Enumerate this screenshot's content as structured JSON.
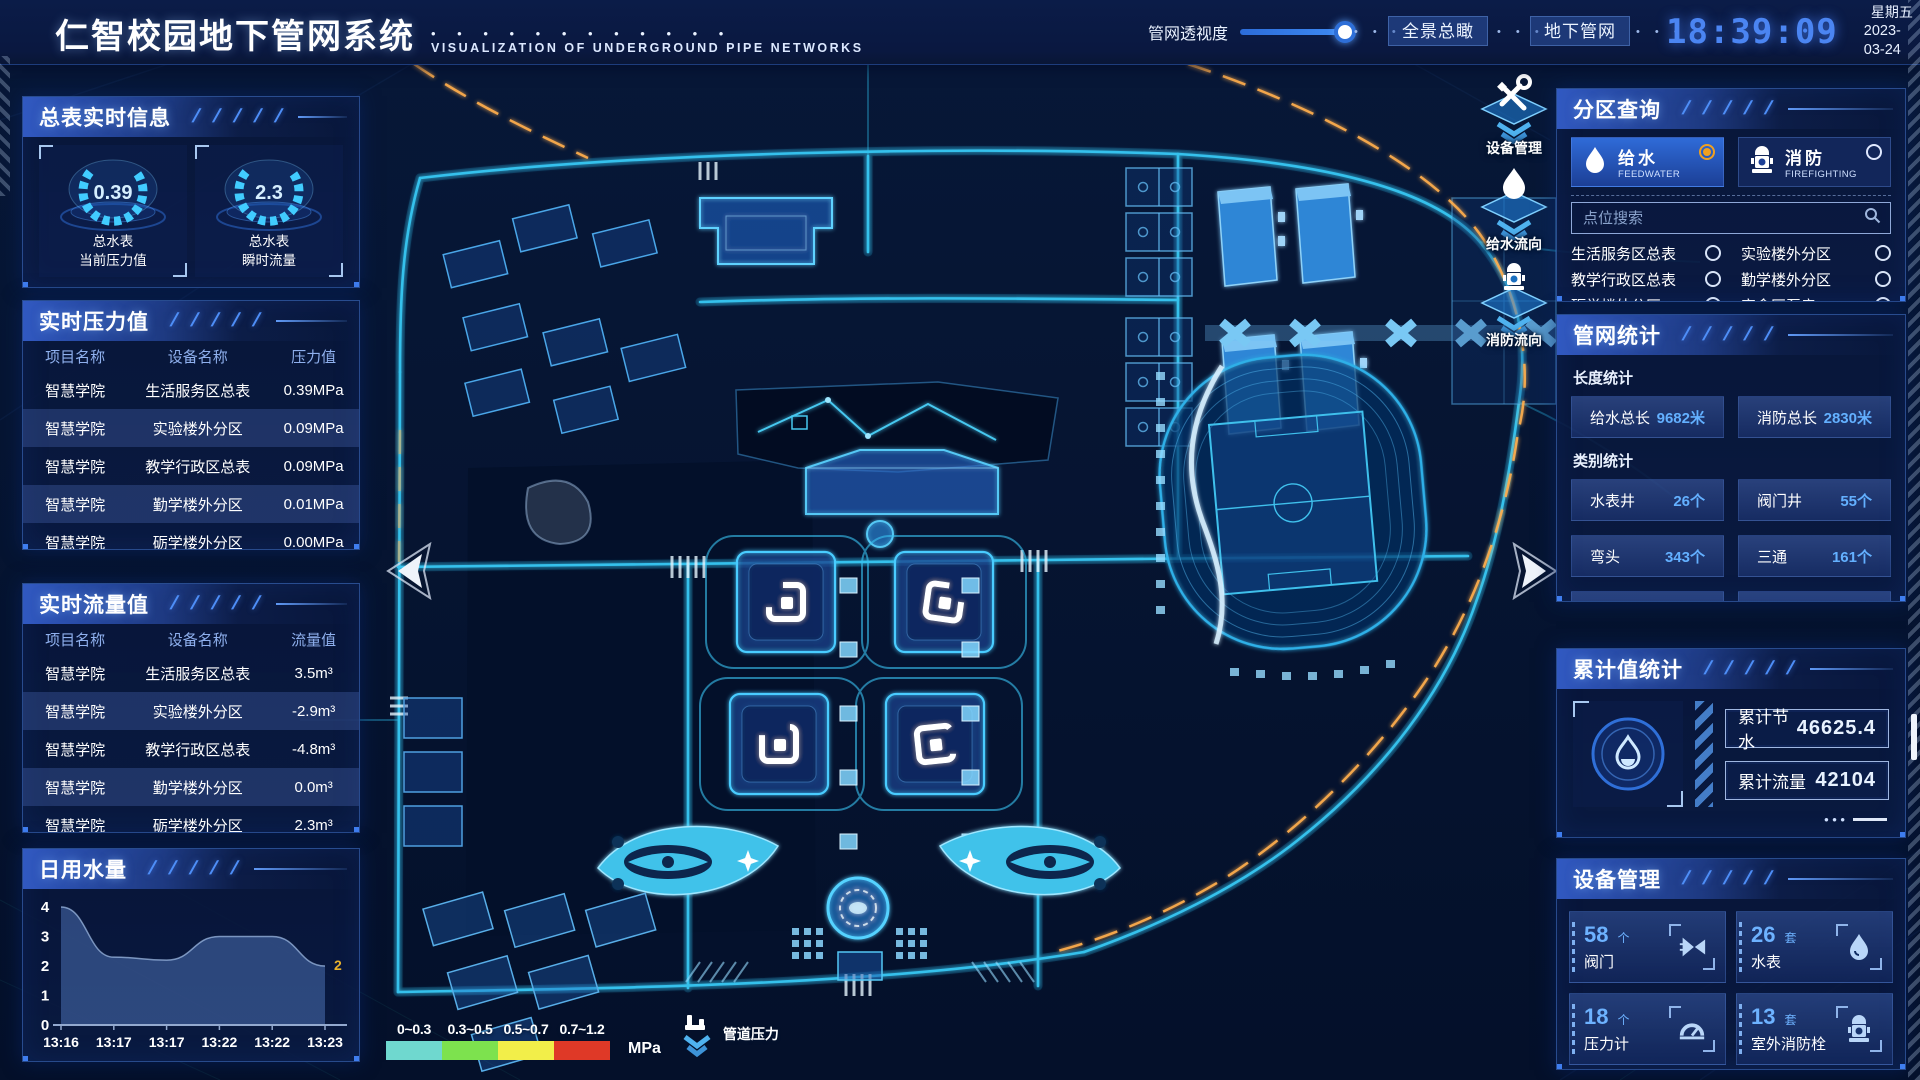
{
  "deco": {
    "slashes": "/ / / / /",
    "dots": "• • •",
    "title_dots": "•  •  •  •  •  •  •  •  •  •  •  •",
    "ellipsis": "• • •"
  },
  "header": {
    "title": "仁智校园地下管网系统",
    "subtitle": "VISUALIZATION OF UNDERGROUND PIPE NETWORKS",
    "slider_label": "管网透视度",
    "btn_overview": "全景总瞰",
    "btn_underground": "地下管网",
    "time": "18:39:09",
    "weekday": "星期五",
    "date": "2023-03-24"
  },
  "left": {
    "meter_panel": {
      "title": "总表实时信息",
      "gauges": [
        {
          "value": "0.39",
          "line1": "总水表",
          "line2": "当前压力值"
        },
        {
          "value": "2.3",
          "line1": "总水表",
          "line2": "瞬时流量"
        }
      ]
    },
    "pressure_panel": {
      "title": "实时压力值",
      "headers": [
        "项目名称",
        "设备名称",
        "压力值"
      ],
      "rows": [
        [
          "智慧学院",
          "生活服务区总表",
          "0.39MPa"
        ],
        [
          "智慧学院",
          "实验楼外分区",
          "0.09MPa"
        ],
        [
          "智慧学院",
          "教学行政区总表",
          "0.09MPa"
        ],
        [
          "智慧学院",
          "勤学楼外分区",
          "0.01MPa"
        ],
        [
          "智慧学院",
          "砺学楼外分区",
          "0.00MPa"
        ]
      ]
    },
    "flow_panel": {
      "title": "实时流量值",
      "headers": [
        "项目名称",
        "设备名称",
        "流量值"
      ],
      "rows": [
        [
          "智慧学院",
          "生活服务区总表",
          "3.5m³"
        ],
        [
          "智慧学院",
          "实验楼外分区",
          "-2.9m³"
        ],
        [
          "智慧学院",
          "教学行政区总表",
          "-4.8m³"
        ],
        [
          "智慧学院",
          "勤学楼外分区",
          "0.0m³"
        ],
        [
          "智慧学院",
          "砺学楼外分区",
          "2.3m³"
        ]
      ]
    },
    "daily_panel": {
      "title": "日用水量"
    }
  },
  "chart_data": {
    "type": "area",
    "title": "日用水量",
    "x": [
      "13:16",
      "13:17",
      "13:17",
      "13:22",
      "13:22",
      "13:23"
    ],
    "values": [
      4,
      2.3,
      2.2,
      3,
      3,
      2
    ],
    "xlabel": "",
    "ylabel": "",
    "ylim": [
      0,
      4
    ],
    "yticks": [
      0,
      1,
      2,
      3,
      4
    ],
    "grid": false,
    "legend_position": "none",
    "end_label": "2"
  },
  "right": {
    "zone_panel": {
      "title": "分区查询",
      "modes": [
        {
          "label": "给水",
          "sub": "FEEDWATER",
          "selected": true
        },
        {
          "label": "消防",
          "sub": "FIREFIGHTING",
          "selected": false
        }
      ],
      "search_placeholder": "点位搜索",
      "items": [
        "生活服务区总表",
        "实验楼外分区",
        "教学行政区总表",
        "勤学楼外分区",
        "砺学楼外分区",
        "宿舍区泵房"
      ]
    },
    "stats_panel": {
      "title": "管网统计",
      "length_title": "长度统计",
      "length_stats": [
        {
          "label": "给水总长",
          "value": "9682米"
        },
        {
          "label": "消防总长",
          "value": "2830米"
        }
      ],
      "category_title": "类别统计",
      "category_stats": [
        {
          "label": "水表井",
          "value": "26个"
        },
        {
          "label": "阀门井",
          "value": "55个"
        },
        {
          "label": "弯头",
          "value": "343个"
        },
        {
          "label": "三通",
          "value": "161个"
        }
      ]
    },
    "cumulative_panel": {
      "title": "累计值统计",
      "rows": [
        {
          "label": "累计节水",
          "value": "46625.4"
        },
        {
          "label": "累计流量",
          "value": "42104"
        }
      ]
    },
    "device_panel": {
      "title": "设备管理",
      "cards": [
        {
          "count": "58",
          "unit": "个",
          "label": "阀门"
        },
        {
          "count": "26",
          "unit": "套",
          "label": "水表"
        },
        {
          "count": "18",
          "unit": "个",
          "label": "压力计"
        },
        {
          "count": "13",
          "unit": "套",
          "label": "室外消防栓"
        }
      ]
    }
  },
  "map": {
    "tools": [
      {
        "label": "设备管理"
      },
      {
        "label": "给水流向"
      },
      {
        "label": "消防流向"
      }
    ],
    "legend": {
      "ranges": [
        "0~0.3",
        "0.3~0.5",
        "0.5~0.7",
        "0.7~1.2"
      ],
      "colors": [
        "#6fd8cf",
        "#7de24e",
        "#f2ee49",
        "#df3927"
      ],
      "unit": "MPa",
      "label": "管道压力"
    }
  },
  "colors": {
    "accent": "#3f8cff",
    "cyan_glow": "#35c8f5",
    "amber_flow": "#ffae4e",
    "selected_radio": "#f0a020",
    "value_blue": "#63b0ff",
    "clock_blue": "#4b85f2",
    "chart_end_label": "#e8b12c"
  }
}
